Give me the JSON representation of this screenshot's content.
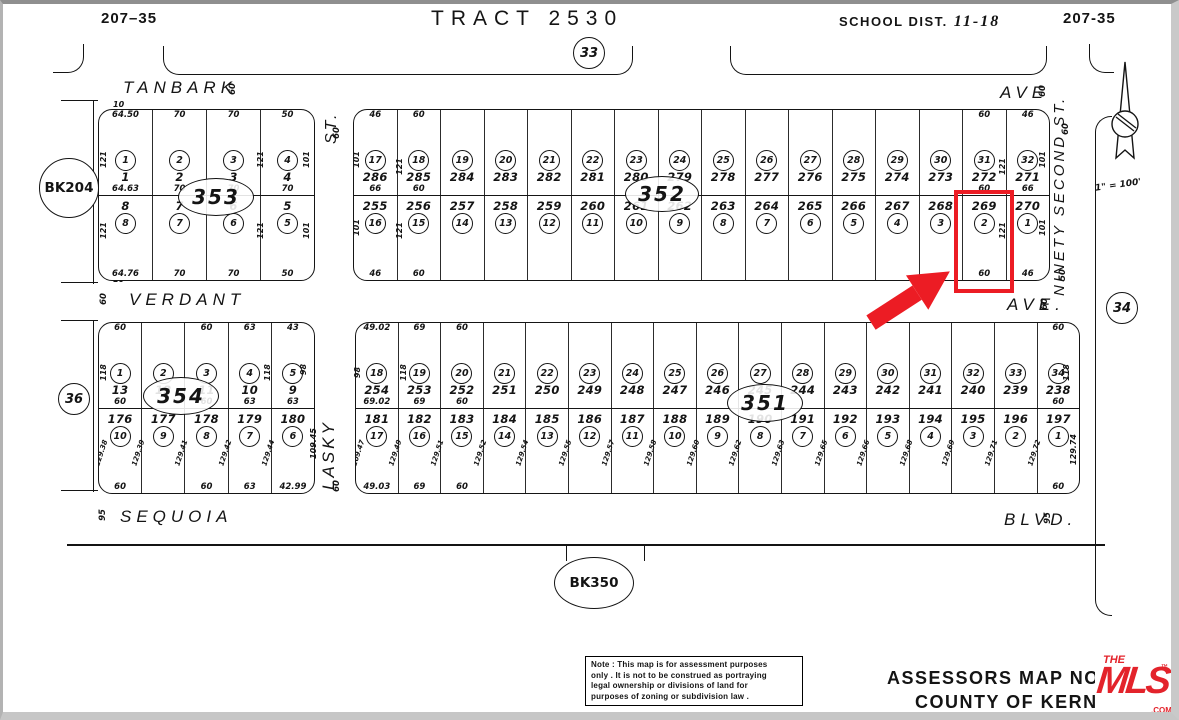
{
  "header": {
    "page_left": "207–35",
    "title": "TRACT 2530",
    "school_district_label": "SCHOOL DIST.",
    "school_district_value": "11-18",
    "page_right": "207-35"
  },
  "circles": {
    "c33": "33",
    "c34": "34",
    "c36": "36",
    "bk204": "BK204",
    "bk350": "BK350"
  },
  "north_arrow": {
    "scale": "1\" = 100'"
  },
  "streets": {
    "tanbark": {
      "name": "TANBARK",
      "mark": "60"
    },
    "ave_top": {
      "name": "AVE",
      "mark": "60"
    },
    "verdant": {
      "name": "VERDANT",
      "mark": "60"
    },
    "ave_mid": {
      "name": "AVE.",
      "mark": "60"
    },
    "sequoia": {
      "name": "SEQUOIA",
      "mark": "95"
    },
    "blvd": {
      "name": "BLVD.",
      "mark": "95"
    },
    "st_top": {
      "name": "ST.",
      "mark": "60"
    },
    "lasky": {
      "name": "LASKY",
      "mark": "60"
    },
    "ninety_second": {
      "name": "NINETY SECOND ST.",
      "mark_top": "60",
      "mark_bottom": "50"
    }
  },
  "highlight": {
    "parcel": "269",
    "color": "#ec1c24"
  },
  "blocks": {
    "b353": {
      "label": "353",
      "corner_marks": [
        "10",
        "10"
      ],
      "top_row": [
        {
          "lot": "1",
          "parcel": "1",
          "t": "64.50",
          "s": "64.63"
        },
        {
          "lot": "2",
          "parcel": "2",
          "t": "70",
          "s": "70"
        },
        {
          "lot": "3",
          "parcel": "3",
          "t": "70",
          "s": "70"
        },
        {
          "lot": "4",
          "parcel": "4",
          "t": "50",
          "s": "70"
        }
      ],
      "bottom_row": [
        {
          "parcel": "8",
          "lot": "8",
          "b": "64.76"
        },
        {
          "parcel": "7",
          "lot": "7",
          "b": "70"
        },
        {
          "parcel": "6",
          "lot": "6",
          "b": "70"
        },
        {
          "parcel": "5",
          "lot": "5",
          "b": "50"
        }
      ],
      "side_dims": [
        {
          "x": 0.03,
          "y": 0.3,
          "v": "121"
        },
        {
          "x": 0.03,
          "y": 0.72,
          "v": "121"
        },
        {
          "x": 0.76,
          "y": 0.3,
          "v": "121"
        },
        {
          "x": 0.76,
          "y": 0.72,
          "v": "121"
        },
        {
          "x": 0.97,
          "y": 0.3,
          "v": "101"
        },
        {
          "x": 0.97,
          "y": 0.72,
          "v": "101"
        }
      ]
    },
    "b352": {
      "label": "352",
      "top_row": [
        {
          "lot": "17",
          "parcel": "286",
          "t": "46",
          "s": "66"
        },
        {
          "lot": "18",
          "parcel": "285",
          "t": "60",
          "s": "60"
        },
        {
          "lot": "19",
          "parcel": "284"
        },
        {
          "lot": "20",
          "parcel": "283"
        },
        {
          "lot": "21",
          "parcel": "282"
        },
        {
          "lot": "22",
          "parcel": "281"
        },
        {
          "lot": "23",
          "parcel": "280"
        },
        {
          "lot": "24",
          "parcel": "279"
        },
        {
          "lot": "25",
          "parcel": "278"
        },
        {
          "lot": "26",
          "parcel": "277"
        },
        {
          "lot": "27",
          "parcel": "276"
        },
        {
          "lot": "28",
          "parcel": "275"
        },
        {
          "lot": "29",
          "parcel": "274"
        },
        {
          "lot": "30",
          "parcel": "273"
        },
        {
          "lot": "31",
          "parcel": "272",
          "t": "60",
          "s": "60"
        },
        {
          "lot": "32",
          "parcel": "271",
          "t": "46",
          "s": "66"
        }
      ],
      "bottom_row": [
        {
          "parcel": "255",
          "lot": "16",
          "b": "46"
        },
        {
          "parcel": "256",
          "lot": "15",
          "b": "60"
        },
        {
          "parcel": "257",
          "lot": "14"
        },
        {
          "parcel": "258",
          "lot": "13"
        },
        {
          "parcel": "259",
          "lot": "12"
        },
        {
          "parcel": "260",
          "lot": "11"
        },
        {
          "parcel": "261",
          "lot": "10"
        },
        {
          "parcel": "262",
          "lot": "9"
        },
        {
          "parcel": "263",
          "lot": "8"
        },
        {
          "parcel": "264",
          "lot": "7"
        },
        {
          "parcel": "265",
          "lot": "6"
        },
        {
          "parcel": "266",
          "lot": "5"
        },
        {
          "parcel": "267",
          "lot": "4"
        },
        {
          "parcel": "268",
          "lot": "3"
        },
        {
          "parcel": "269",
          "lot": "2",
          "b": "60",
          "highlight": true
        },
        {
          "parcel": "270",
          "lot": "1",
          "b": "46"
        }
      ],
      "side_dims": [
        {
          "x": 0.006,
          "y": 0.3,
          "v": "101"
        },
        {
          "x": 0.068,
          "y": 0.34,
          "v": "121"
        },
        {
          "x": 0.006,
          "y": 0.7,
          "v": "101"
        },
        {
          "x": 0.068,
          "y": 0.72,
          "v": "121"
        },
        {
          "x": 0.935,
          "y": 0.34,
          "v": "121"
        },
        {
          "x": 0.993,
          "y": 0.3,
          "v": "101"
        },
        {
          "x": 0.935,
          "y": 0.72,
          "v": "121"
        },
        {
          "x": 0.993,
          "y": 0.7,
          "v": "101"
        }
      ]
    },
    "b354": {
      "label": "354",
      "top_row": [
        {
          "lot": "1",
          "parcel": "13",
          "t": "60",
          "s": "60"
        },
        {
          "lot": "2",
          "parcel": "12"
        },
        {
          "lot": "3",
          "parcel": "11",
          "t": "60",
          "s": "60"
        },
        {
          "lot": "4",
          "parcel": "10",
          "t": "63",
          "s": "63"
        },
        {
          "lot": "5",
          "parcel": "9",
          "t": "43",
          "s": "63"
        }
      ],
      "bottom_row": [
        {
          "parcel": "176",
          "lot": "10",
          "b": "60",
          "side": "129.38"
        },
        {
          "parcel": "177",
          "lot": "9",
          "side": "129.39"
        },
        {
          "parcel": "178",
          "lot": "8",
          "b": "60",
          "side": "129.41"
        },
        {
          "parcel": "179",
          "lot": "7",
          "b": "63",
          "side": "129.42"
        },
        {
          "parcel": "180",
          "lot": "6",
          "b": "42.99",
          "side": "129.44"
        }
      ],
      "side_dims": [
        {
          "x": 0.03,
          "y": 0.3,
          "v": "118"
        },
        {
          "x": 0.79,
          "y": 0.3,
          "v": "118"
        },
        {
          "x": 0.97,
          "y": 0.28,
          "v": "98"
        },
        {
          "x": 0.97,
          "y": 0.72,
          "v": "109.45"
        }
      ]
    },
    "b351": {
      "label": "351",
      "top_row": [
        {
          "lot": "18",
          "parcel": "254",
          "t": "49.02",
          "s": "69.02"
        },
        {
          "lot": "19",
          "parcel": "253",
          "t": "69",
          "s": "69"
        },
        {
          "lot": "20",
          "parcel": "252",
          "t": "60",
          "s": "60"
        },
        {
          "lot": "21",
          "parcel": "251"
        },
        {
          "lot": "22",
          "parcel": "250"
        },
        {
          "lot": "23",
          "parcel": "249"
        },
        {
          "lot": "24",
          "parcel": "248"
        },
        {
          "lot": "25",
          "parcel": "247"
        },
        {
          "lot": "26",
          "parcel": "246"
        },
        {
          "lot": "27",
          "parcel": "245"
        },
        {
          "lot": "28",
          "parcel": "244"
        },
        {
          "lot": "29",
          "parcel": "243"
        },
        {
          "lot": "30",
          "parcel": "242"
        },
        {
          "lot": "31",
          "parcel": "241"
        },
        {
          "lot": "32",
          "parcel": "240"
        },
        {
          "lot": "33",
          "parcel": "239"
        },
        {
          "lot": "34",
          "parcel": "238",
          "t": "60",
          "s": "60"
        }
      ],
      "bottom_row": [
        {
          "parcel": "181",
          "lot": "17",
          "b": "49.03",
          "side": "109.47"
        },
        {
          "parcel": "182",
          "lot": "16",
          "b": "69",
          "side": "129.49"
        },
        {
          "parcel": "183",
          "lot": "15",
          "b": "60",
          "side": "129.51"
        },
        {
          "parcel": "184",
          "lot": "14",
          "side": "129.52"
        },
        {
          "parcel": "185",
          "lot": "13",
          "side": "129.54"
        },
        {
          "parcel": "186",
          "lot": "12",
          "side": "129.55"
        },
        {
          "parcel": "187",
          "lot": "11",
          "side": "129.57"
        },
        {
          "parcel": "188",
          "lot": "10",
          "side": "129.58"
        },
        {
          "parcel": "189",
          "lot": "9",
          "side": "129.60"
        },
        {
          "parcel": "190",
          "lot": "8",
          "side": "129.62"
        },
        {
          "parcel": "191",
          "lot": "7",
          "side": "129.63"
        },
        {
          "parcel": "192",
          "lot": "6",
          "side": "129.65"
        },
        {
          "parcel": "193",
          "lot": "5",
          "side": "129.66"
        },
        {
          "parcel": "194",
          "lot": "4",
          "side": "129.68"
        },
        {
          "parcel": "195",
          "lot": "3",
          "side": "129.69"
        },
        {
          "parcel": "196",
          "lot": "2",
          "side": "129.71"
        },
        {
          "parcel": "197",
          "lot": "1",
          "b": "60",
          "side": "129.72"
        }
      ],
      "side_dims": [
        {
          "x": 0.008,
          "y": 0.3,
          "v": "98"
        },
        {
          "x": 0.068,
          "y": 0.3,
          "v": "118"
        },
        {
          "x": 0.985,
          "y": 0.3,
          "v": "118"
        },
        {
          "x": 0.985,
          "y": 0.75,
          "v": "129.74"
        }
      ]
    }
  },
  "note_box": {
    "lines": [
      "Note : This map is for assessment purposes",
      "only . It is not to be construed as portraying",
      "legal ownership or divisions of land for",
      "purposes of zoning or subdivision law ."
    ]
  },
  "footer": {
    "line1": "ASSESSORS MAP NO. 20",
    "line2": "COUNTY OF KERN"
  },
  "logo": {
    "the": "THE",
    "mls": "MLS",
    "tm": "™",
    "com": ".COM",
    "color": "#e3232b"
  }
}
